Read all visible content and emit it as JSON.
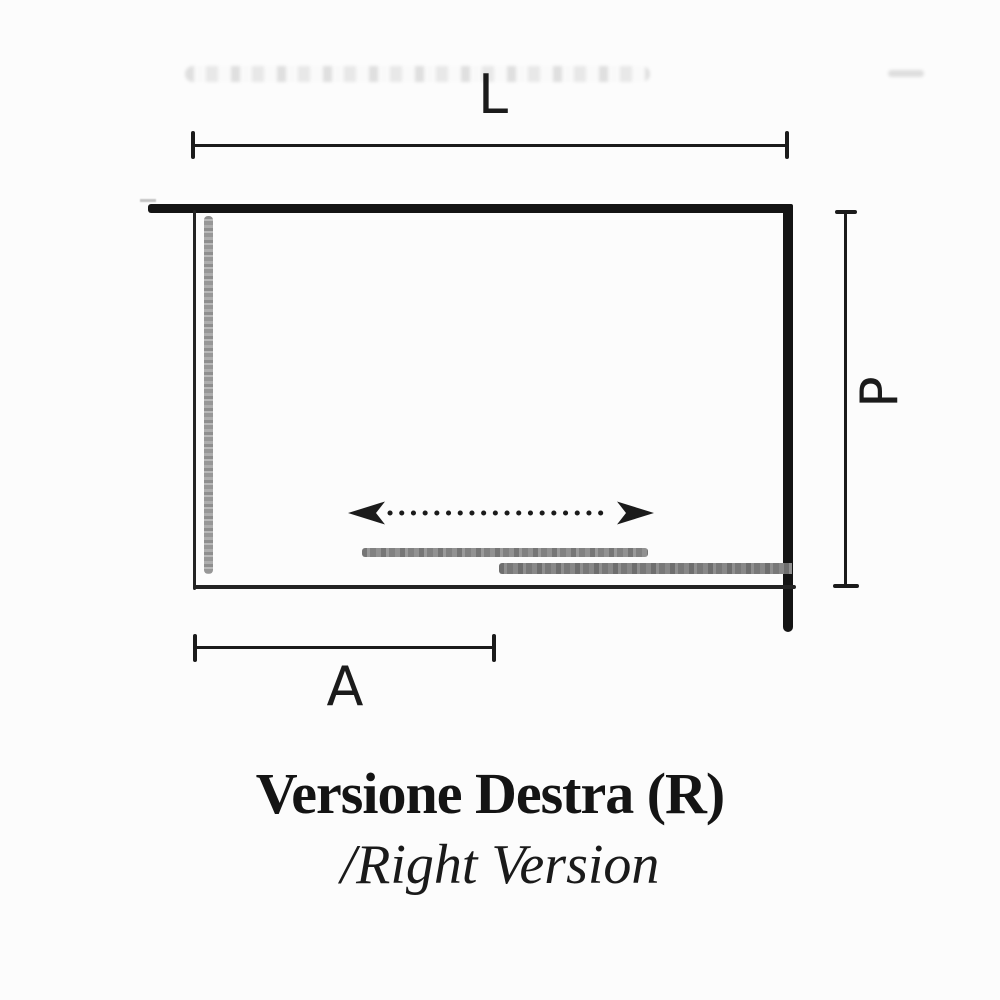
{
  "diagram": {
    "title": "Versione Destra (R)",
    "subtitle": "/Right Version",
    "labels": {
      "width": "L",
      "depth": "P",
      "fixed_side": "A"
    },
    "colors": {
      "ink": "#1b1b1b",
      "wall": "#141414",
      "glass_panel_gray": "#9a9a9a",
      "door_panel_gray": "#828282",
      "background": "#fcfcfc"
    },
    "icons": {
      "slide_direction": "double-headed-dotted-arrow"
    }
  }
}
